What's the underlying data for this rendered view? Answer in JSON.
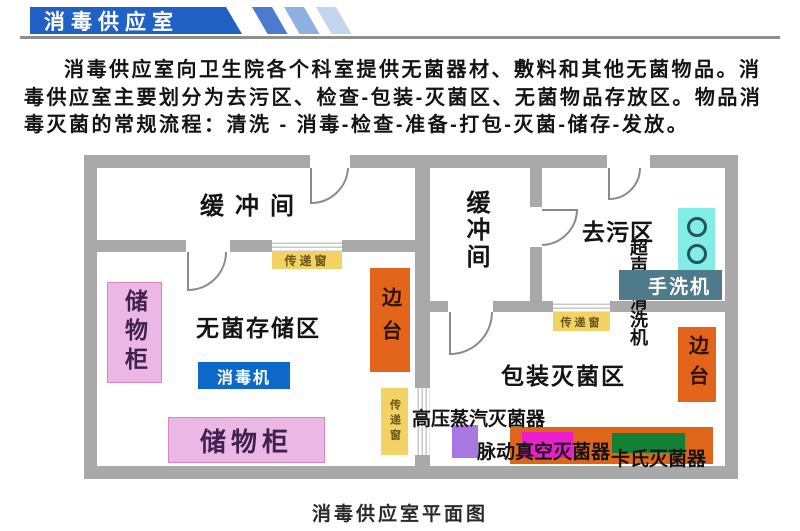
{
  "header": {
    "title": "消毒供应室"
  },
  "intro": {
    "lines": [
      "消毒供应室向卫生院各个科室提供无菌器材、敷料和其他无菌物品。消",
      "毒供应室主要划分为去污区、检查-包装-灭菌区、无菌物品存放区。物品消",
      "毒灭菌的常规流程：清洗 - 消毒-检查-准备-打包-灭菌-储存-发放。"
    ]
  },
  "plan": {
    "rooms": {
      "buffer_room": "缓冲间",
      "sterile_storage": "无菌存储区",
      "decontamination": "去污区",
      "packaging_sterilization": "包装灭菌区"
    },
    "equipment": {
      "cabinet": "储物柜",
      "disinfector": "消毒机",
      "side_table": "边台",
      "transfer_window": "传递窗",
      "ultrasonic_cleaner": "超声波清洗机",
      "hand_washer": "手洗机",
      "autoclave": "高压蒸汽灭菌器",
      "pulse_vacuum_sterilizer": "脉动真空灭菌器",
      "cassette_sterilizer": "卡氏灭菌器"
    }
  },
  "caption": "消毒供应室平面图",
  "colors": {
    "banner_blue": "#2160c4",
    "wall_gray": "#a9a9a9",
    "window_yellow": "#f1d263",
    "table_orange": "#e3651b",
    "cabinet_pink": "#ebb8e6",
    "disinfector_blue": "#0d68c9",
    "cleaner_cyan": "#82ece6",
    "washer_slate": "#4e7a8c",
    "autoclave_purple": "#a878e2",
    "vacuum_magenta": "#ea1ecd",
    "cassette_green": "#128035"
  }
}
